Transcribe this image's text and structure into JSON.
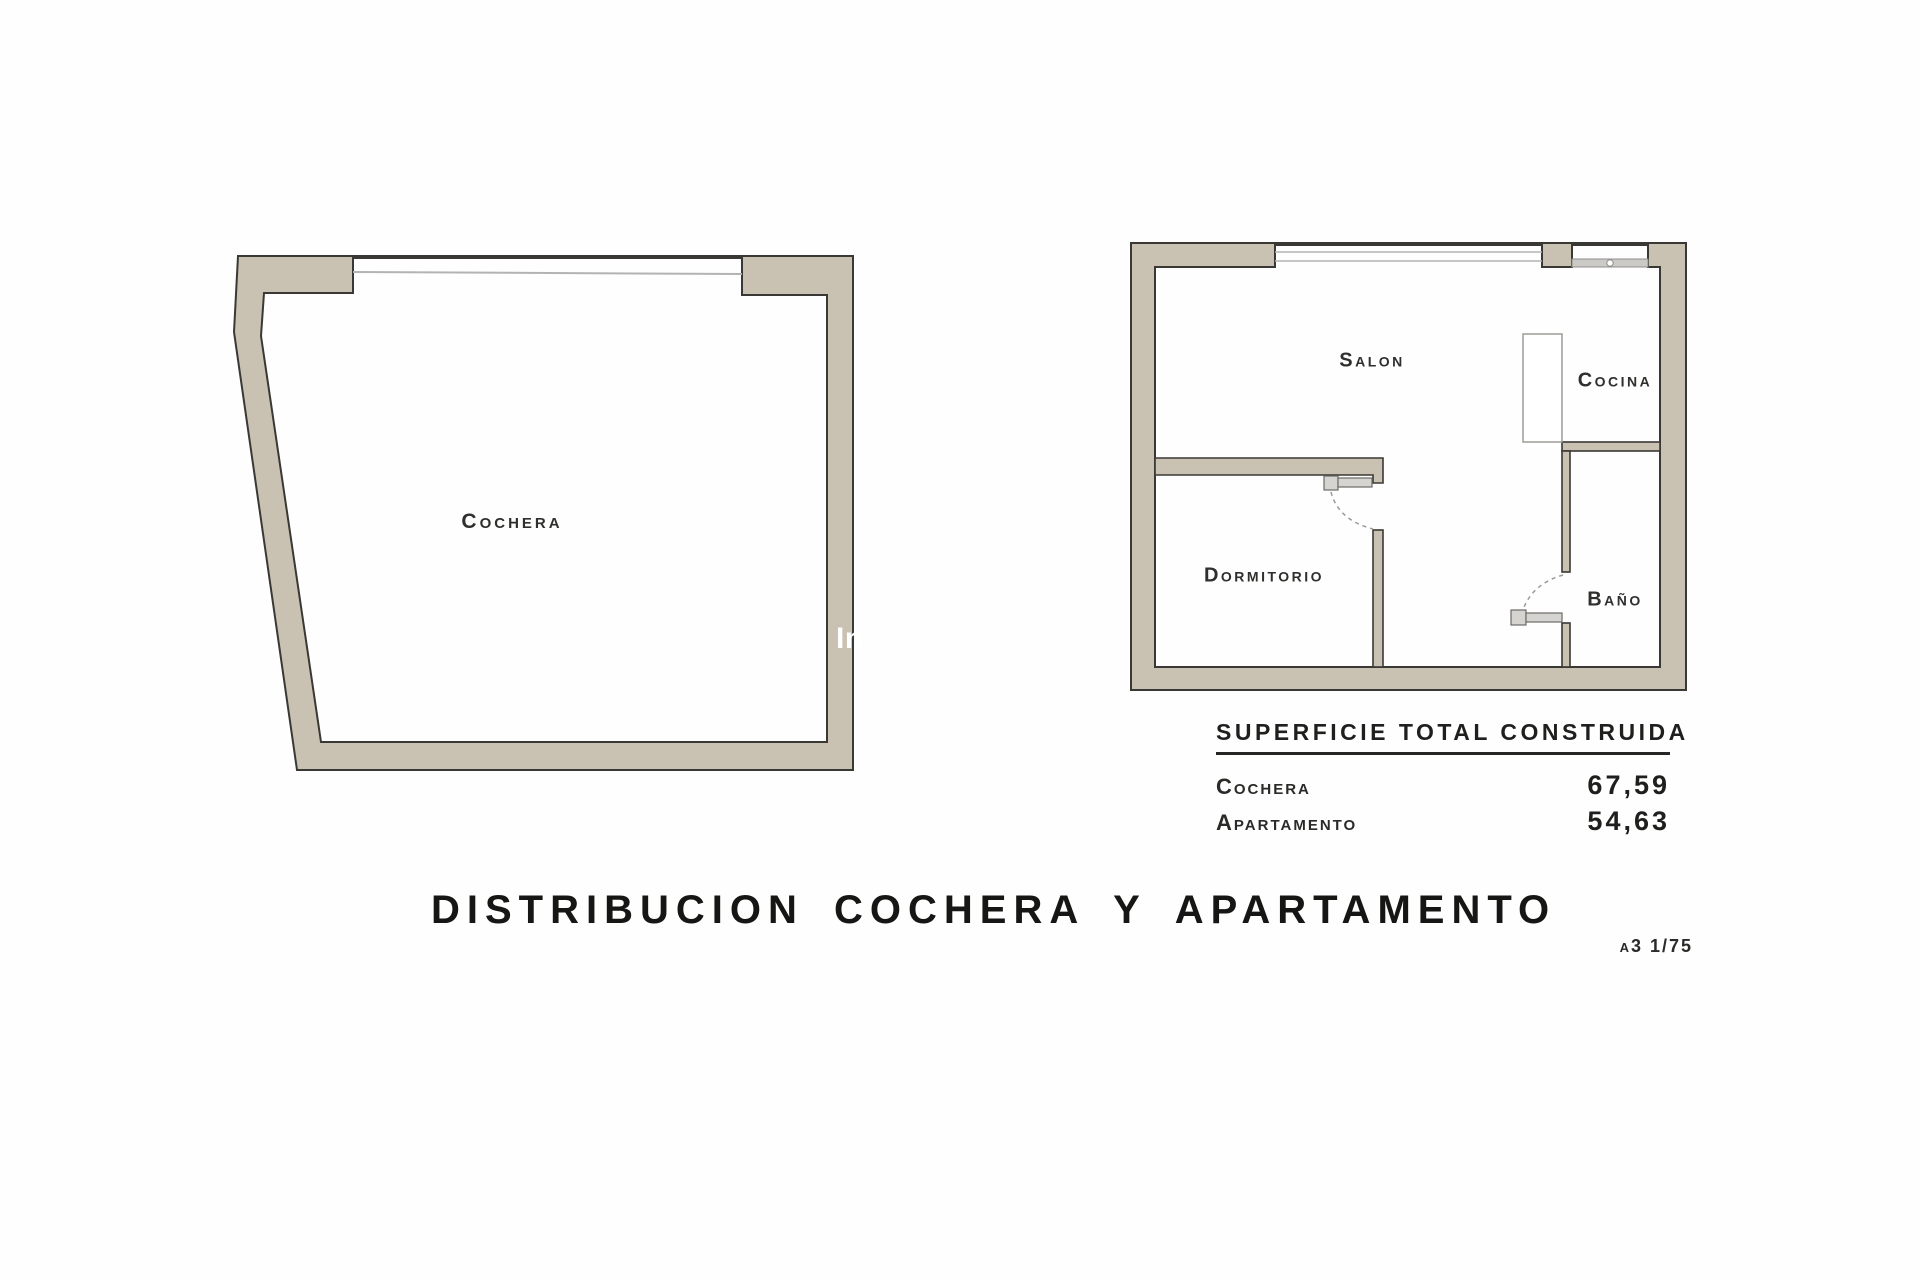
{
  "colors": {
    "wall_fill": "#c9c1b1",
    "wall_outline": "#3a3834",
    "window_line": "#b3b3b1",
    "text": "#262624"
  },
  "cochera_plan": {
    "room_label": "Cochera",
    "watermark": "In"
  },
  "apartment_plan": {
    "salon_label": "Salon",
    "cocina_label": "Cocina",
    "dormitorio_label": "Dormitorio",
    "bano_label": "Baño"
  },
  "summary_table": {
    "heading": "SUPERFICIE TOTAL CONSTRUIDA",
    "rows": [
      {
        "label": "Cochera",
        "value": "67,59"
      },
      {
        "label": "Apartamento",
        "value": "54,63"
      }
    ]
  },
  "footer": {
    "title": "DISTRIBUCION COCHERA Y APARTAMENTO",
    "scale_note": "a3 1/75"
  }
}
